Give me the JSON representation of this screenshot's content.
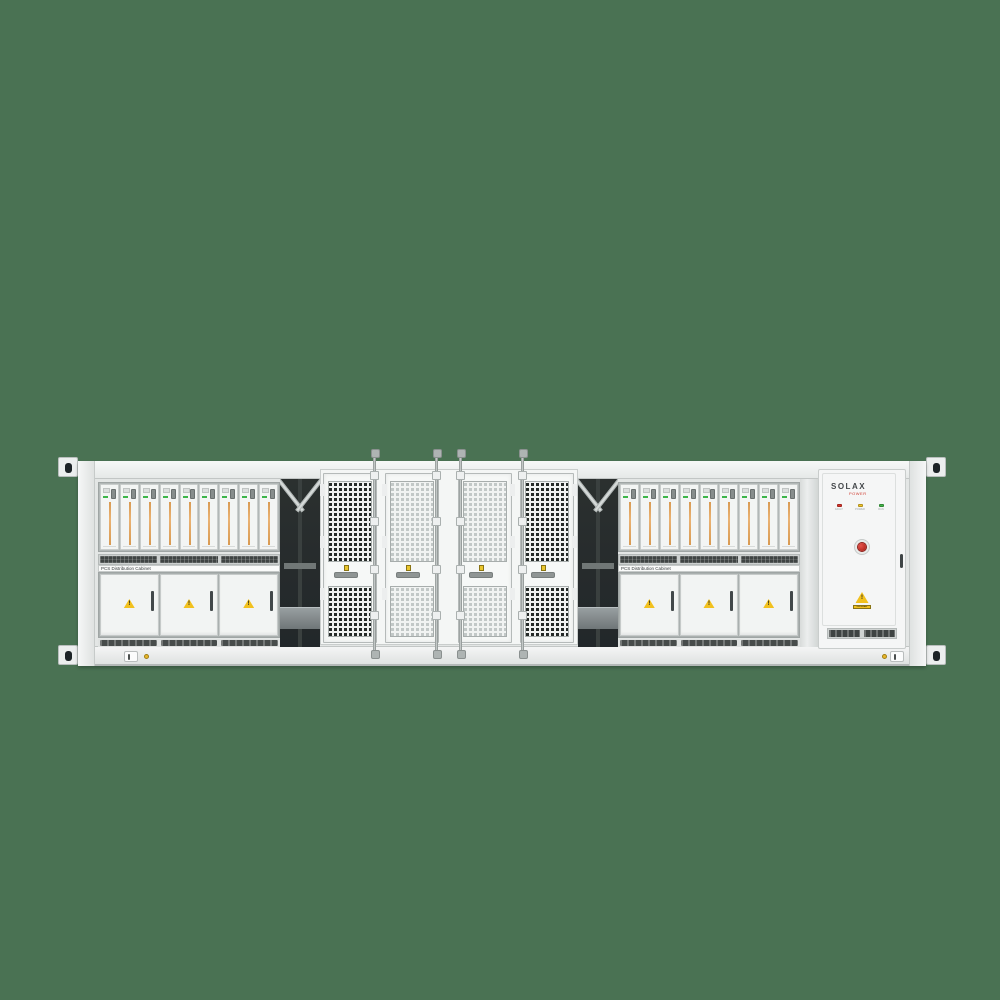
{
  "scene": {
    "background_color": "#4a7253"
  },
  "icons": {
    "warning_glyph": "!"
  },
  "left_rack": {
    "label": "PCS Distribution Cabinet",
    "module_count": 9,
    "door_count": 3
  },
  "right_rack": {
    "label": "PCS Distribution Cabinet",
    "module_count": 9,
    "door_count": 3
  },
  "mesh_bay": {
    "door_count": 4
  },
  "solax_cabinet": {
    "brand": "SOLAX",
    "brand_sub": "POWER",
    "indicators": [
      {
        "label": "FAULT",
        "color": "#d9342b"
      },
      {
        "label": "POWER",
        "color": "#f0c42a"
      },
      {
        "label": "RUN",
        "color": "#43b649"
      }
    ],
    "warning_text": "DANGER"
  },
  "colors": {
    "container_white": "#eef0ef",
    "module_stripe_orange": "#e2a55e",
    "status_green": "#3db54a",
    "warning_yellow": "#f2c11e",
    "estop_red": "#c22a22",
    "mesh_dark": "#252a28",
    "mesh_light": "#c2c8c7"
  }
}
